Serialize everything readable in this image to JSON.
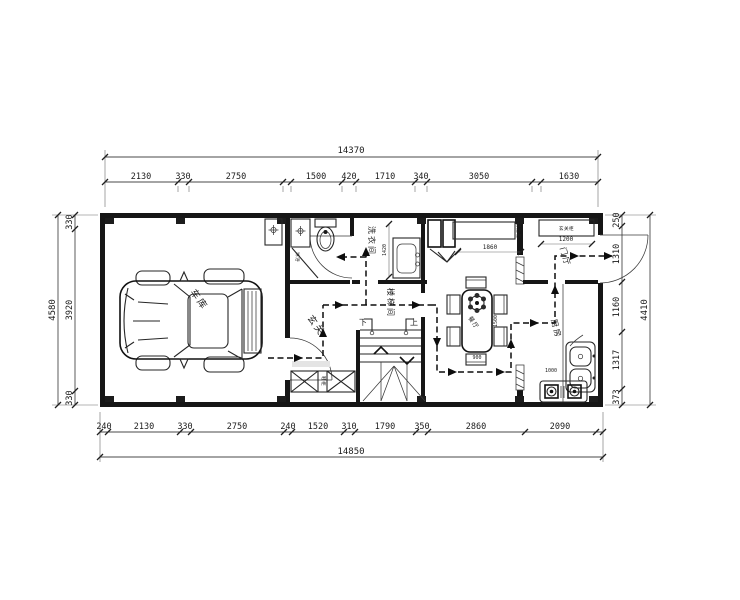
{
  "drawing": {
    "type": "residential floor plan, ground level"
  },
  "labels": {
    "garage": "车库",
    "shower": "淋浴",
    "laundry": "洗衣间",
    "stairwell": "楼梯间",
    "hall": "玄关",
    "hall_cabinet": "鞋柜",
    "dining": "餐厅",
    "kitchen": "厨房",
    "foyer": "门厅",
    "entry_cabinet": "玄关柜",
    "sideboard": "餐边柜",
    "stair_down": "下",
    "stair_up": "上"
  },
  "dims": {
    "top": {
      "total": "14370",
      "segments": [
        "2130",
        "330",
        "2750",
        "1500",
        "420",
        "1710",
        "340",
        "3050",
        "1630"
      ]
    },
    "bottom": {
      "total": "14850",
      "segments": [
        "240",
        "2130",
        "330",
        "2750",
        "240",
        "1520",
        "310",
        "1790",
        "350",
        "2860",
        "2090"
      ]
    },
    "left": {
      "total": "4580",
      "segments": [
        "330",
        "3920",
        "330"
      ]
    },
    "right": {
      "total": "4410",
      "segments": [
        "250",
        "1310",
        "1160",
        "1317",
        "373"
      ]
    },
    "interior": {
      "sideboard": "1860",
      "laundry": "1420",
      "entry_cabinet": "1200",
      "table_length": "1500",
      "table_width": "900",
      "kitchen_counter": "1000"
    }
  }
}
